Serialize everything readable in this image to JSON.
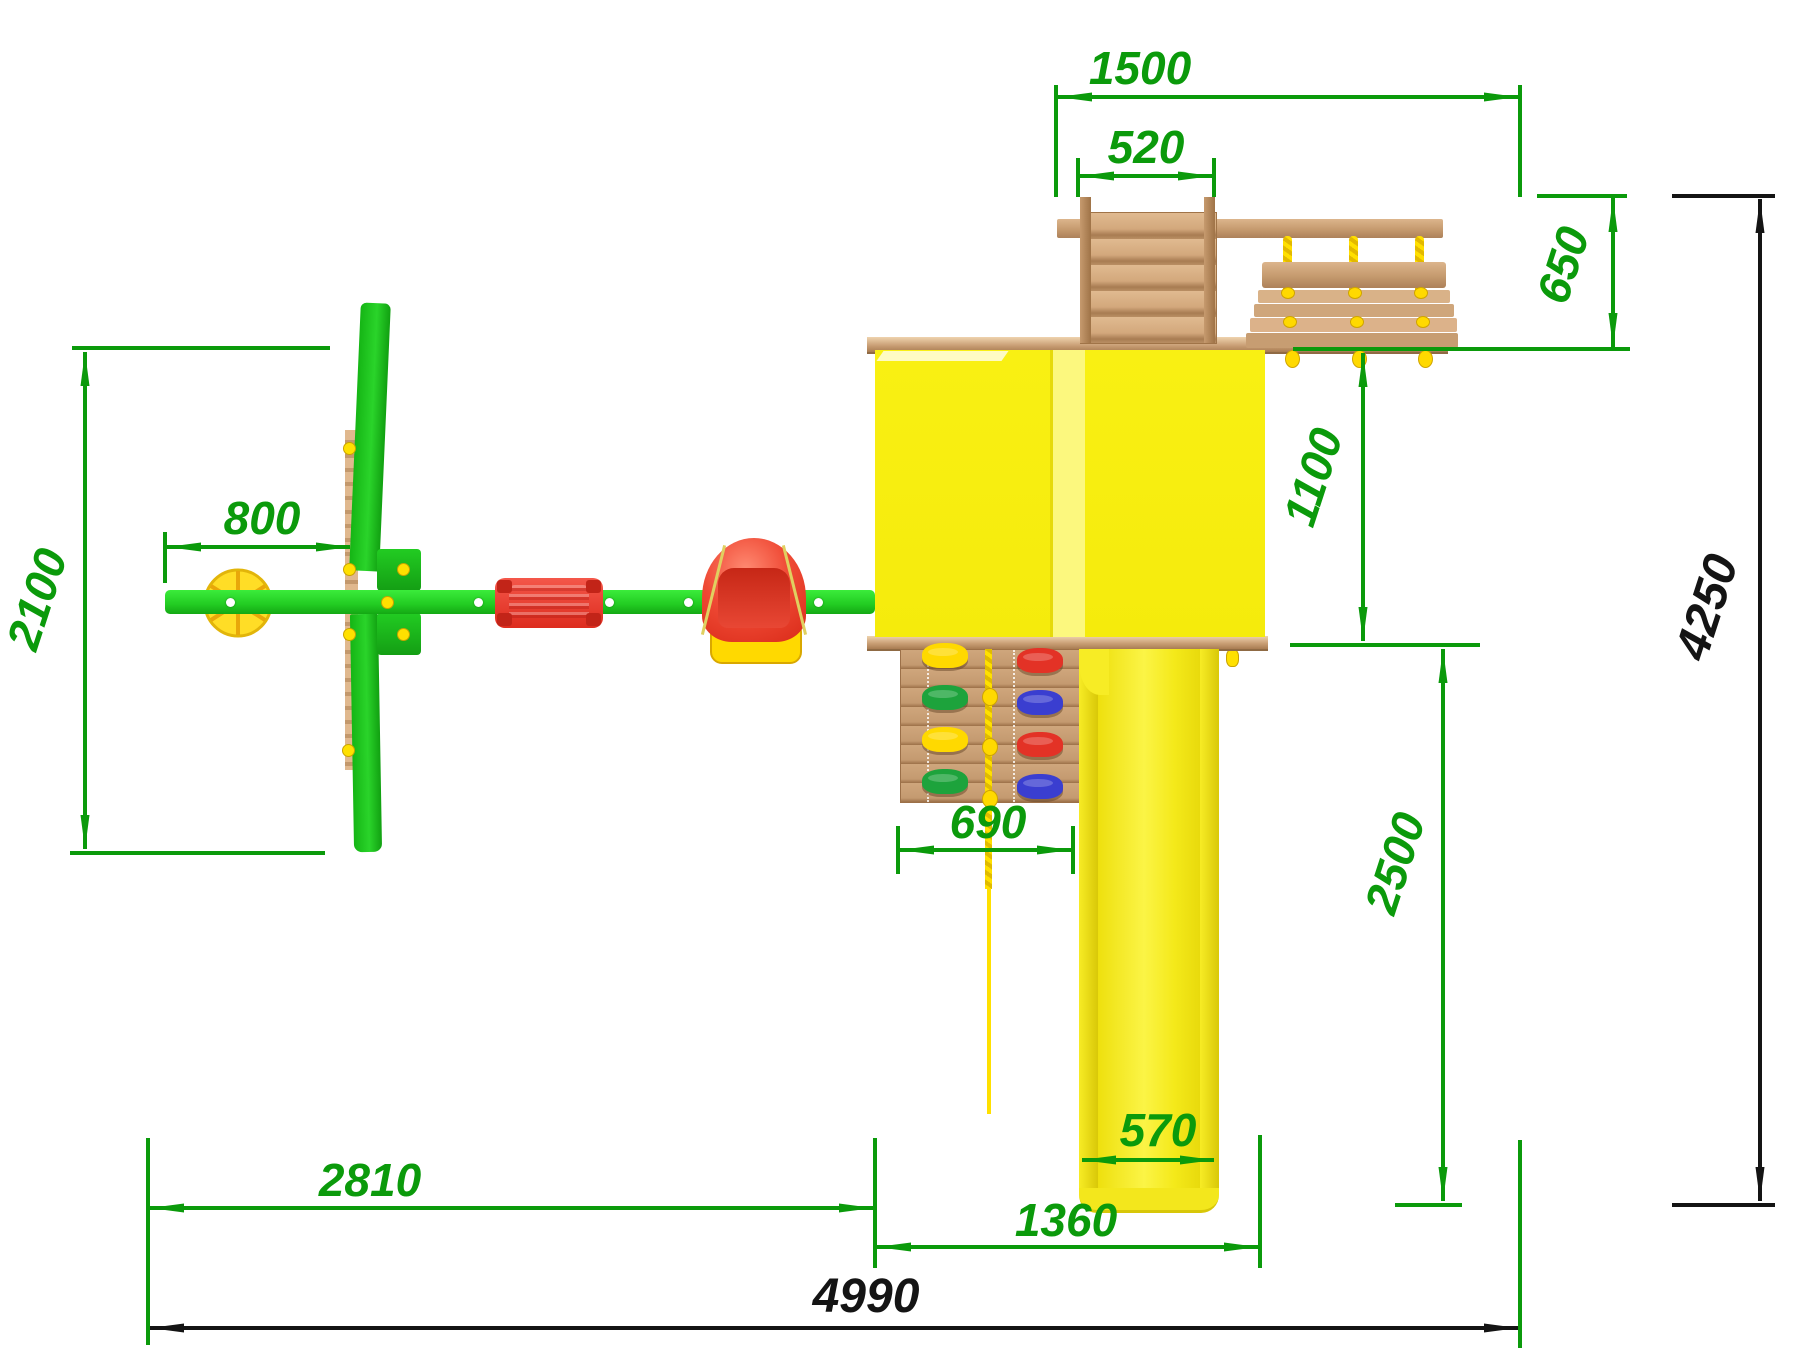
{
  "drawing": {
    "title": "playground-set-top-view-plan",
    "units": "mm",
    "dimensions_mm": {
      "rear_section_width": "1500",
      "ladder_width": "520",
      "bench_swing_depth": "650",
      "platform_depth": "1100",
      "slide_runout_depth": "2500",
      "overall_depth": "4250",
      "swing_offset": "800",
      "swing_frame_depth": "2100",
      "climbing_wall_width": "690",
      "slide_width": "570",
      "swing_section_width": "2810",
      "tower_slide_section_width": "1360",
      "overall_width": "4990"
    },
    "colors": {
      "dimension_green": "#0b9a0b",
      "dimension_black": "#141414",
      "beam_green": "#22cc22",
      "tower_yellow": "#f7ee10",
      "slide_yellow": "#f4e91a",
      "wood_tan": "#c59a6e",
      "rope_yellow": "#ffdf00",
      "seat_red": "#e23320"
    }
  }
}
